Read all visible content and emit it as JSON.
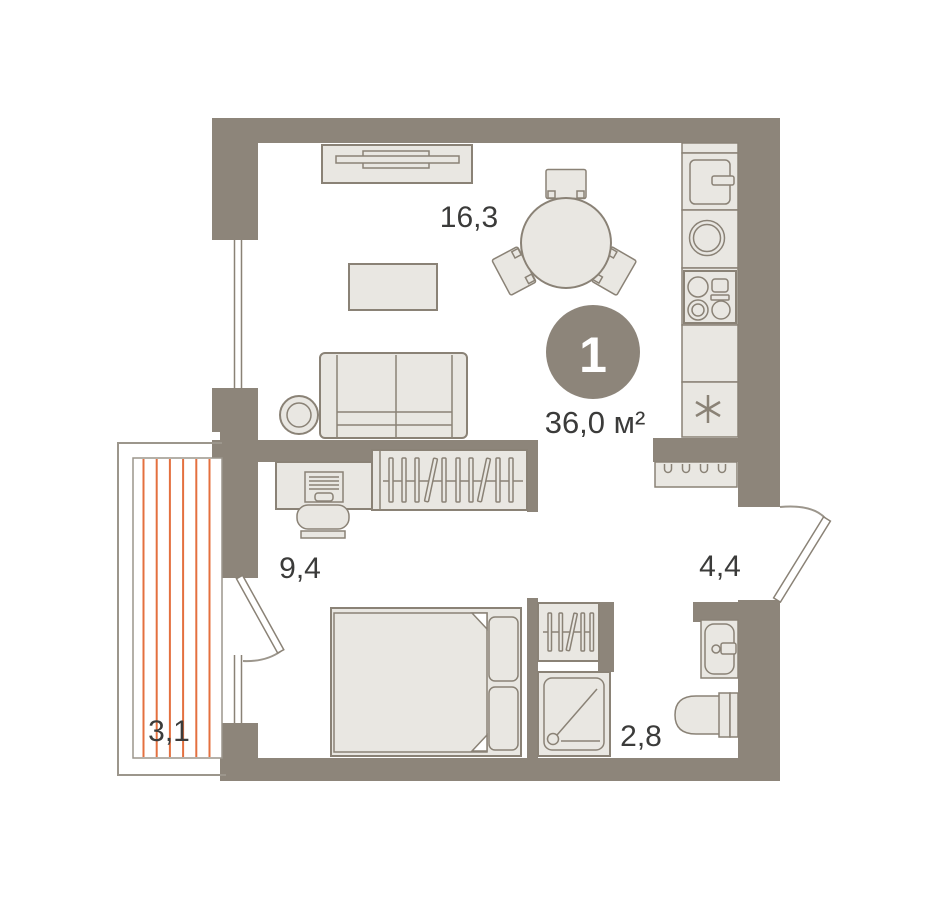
{
  "plan": {
    "title": "one-room apartment floor plan",
    "badge": {
      "number": "1",
      "area": "36,0 м²"
    },
    "rooms": {
      "living_kitchen": {
        "area": "16,3"
      },
      "bedroom": {
        "area": "9,4"
      },
      "hallway": {
        "area": "4,4"
      },
      "bathroom": {
        "area": "2,8"
      },
      "balcony": {
        "area": "3,1"
      }
    },
    "colors": {
      "wall": "#8d857a",
      "furniture_fill": "#e9e7e2",
      "furniture_stroke": "#8a8276",
      "balcony_stripe": "#e4703f",
      "badge_circle": "#8d857a",
      "badge_text": "#ffffff",
      "label_text": "#3b3b3a",
      "background": "#ffffff"
    },
    "icons": {
      "washer_symbol": "asterisk",
      "coat_rack_symbol": "hooks",
      "fixtures": [
        "fridge-icon",
        "kitchen-sink-icon",
        "stove-icon",
        "washer-icon",
        "tv-icon",
        "sofa",
        "coffee-table",
        "side-table",
        "dining-table",
        "chairs",
        "desk",
        "desk-chair",
        "wardrobe",
        "bed",
        "linen-shelf",
        "shower",
        "washbasin-icon",
        "toilet-icon",
        "coat-rack"
      ]
    }
  }
}
